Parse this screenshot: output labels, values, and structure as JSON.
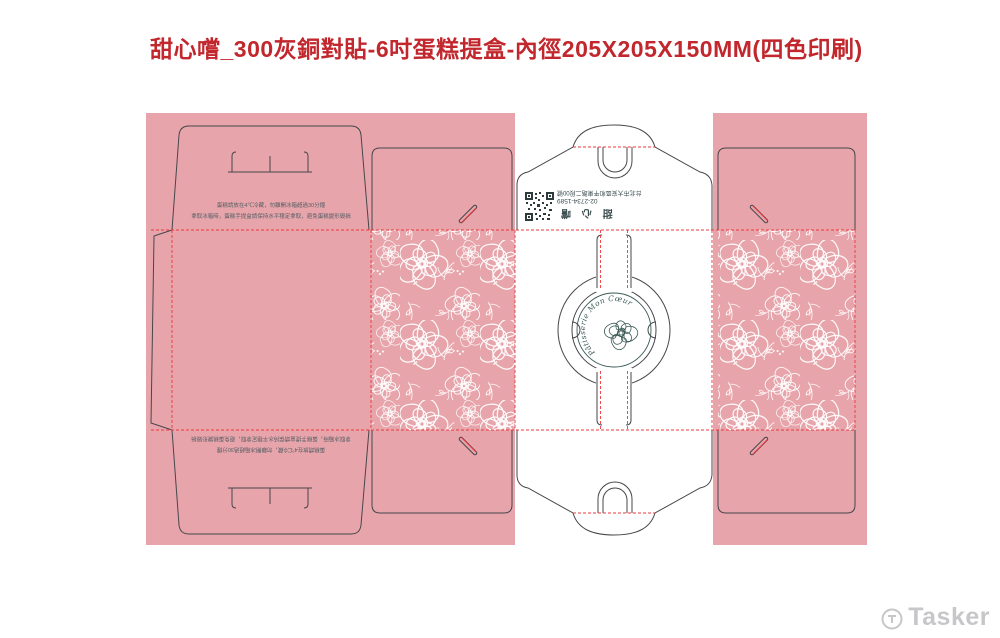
{
  "title": "甜心嚐_300灰銅對貼-6吋蛋糕提盒-內徑205X205X150MM(四色印刷)",
  "care_text": {
    "line1": "蛋糕請放在4℃冷藏，勿離開冰箱超過30分鐘",
    "line2": "拿取冰箱時，蛋糕手提盒請保持水平穩定拿取，避免蛋糕變形毀損"
  },
  "brand_block": {
    "address": "台北市大安區和平東路二段00號",
    "phone": "02-2734-1589",
    "brand": "甜 心 嚐"
  },
  "logo": {
    "curved_text": "Pâtisserie Mon Cœur"
  },
  "watermark": {
    "label": "Tasker"
  },
  "colors": {
    "panel_pink": "#e7a5ab",
    "dieline_stroke": "#47464b",
    "fold_line_red": "#e8383d",
    "title_red": "#c1272d",
    "logo_teal": "#3a5a55",
    "watermark_gray": "#c7c7ca"
  }
}
